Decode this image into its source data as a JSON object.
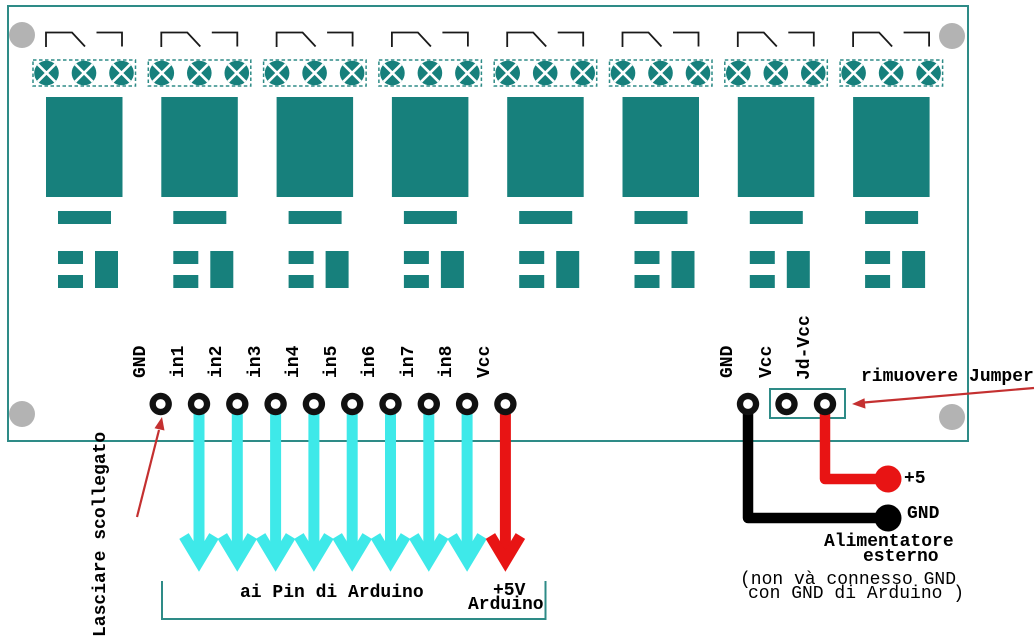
{
  "colors": {
    "teal": "#17807c",
    "outline": "#2e8b87",
    "cyan": "#3ee9e9",
    "red": "#e81414",
    "annotation_red": "#c43030",
    "gray": "#b3b3b3",
    "black": "#000000"
  },
  "board": {
    "relay_count": 8
  },
  "left_header_pins": {
    "labels": [
      "GND",
      "in1",
      "in2",
      "in3",
      "in4",
      "in5",
      "in6",
      "in7",
      "in8",
      "Vcc"
    ],
    "arrows": [
      null,
      "cyan",
      "cyan",
      "cyan",
      "cyan",
      "cyan",
      "cyan",
      "cyan",
      "cyan",
      "red"
    ]
  },
  "right_header_pins": {
    "labels": [
      "GND",
      "Vcc",
      "Jd-Vcc"
    ]
  },
  "annotations": {
    "lasciare_scollegato": "Lasciare scollegato",
    "ai_pin_di_arduino": "ai Pin di Arduino",
    "plus5v": "+5V",
    "plus5v_sub": "Arduino",
    "rimuovere_jumper": "rimuovere Jumper",
    "plus5": "+5",
    "gnd": "GND",
    "alimentatore": "Alimentatore",
    "esterno": "esterno",
    "note_line1": "(non và connesso GND",
    "note_line2": "con GND di Arduino )"
  }
}
